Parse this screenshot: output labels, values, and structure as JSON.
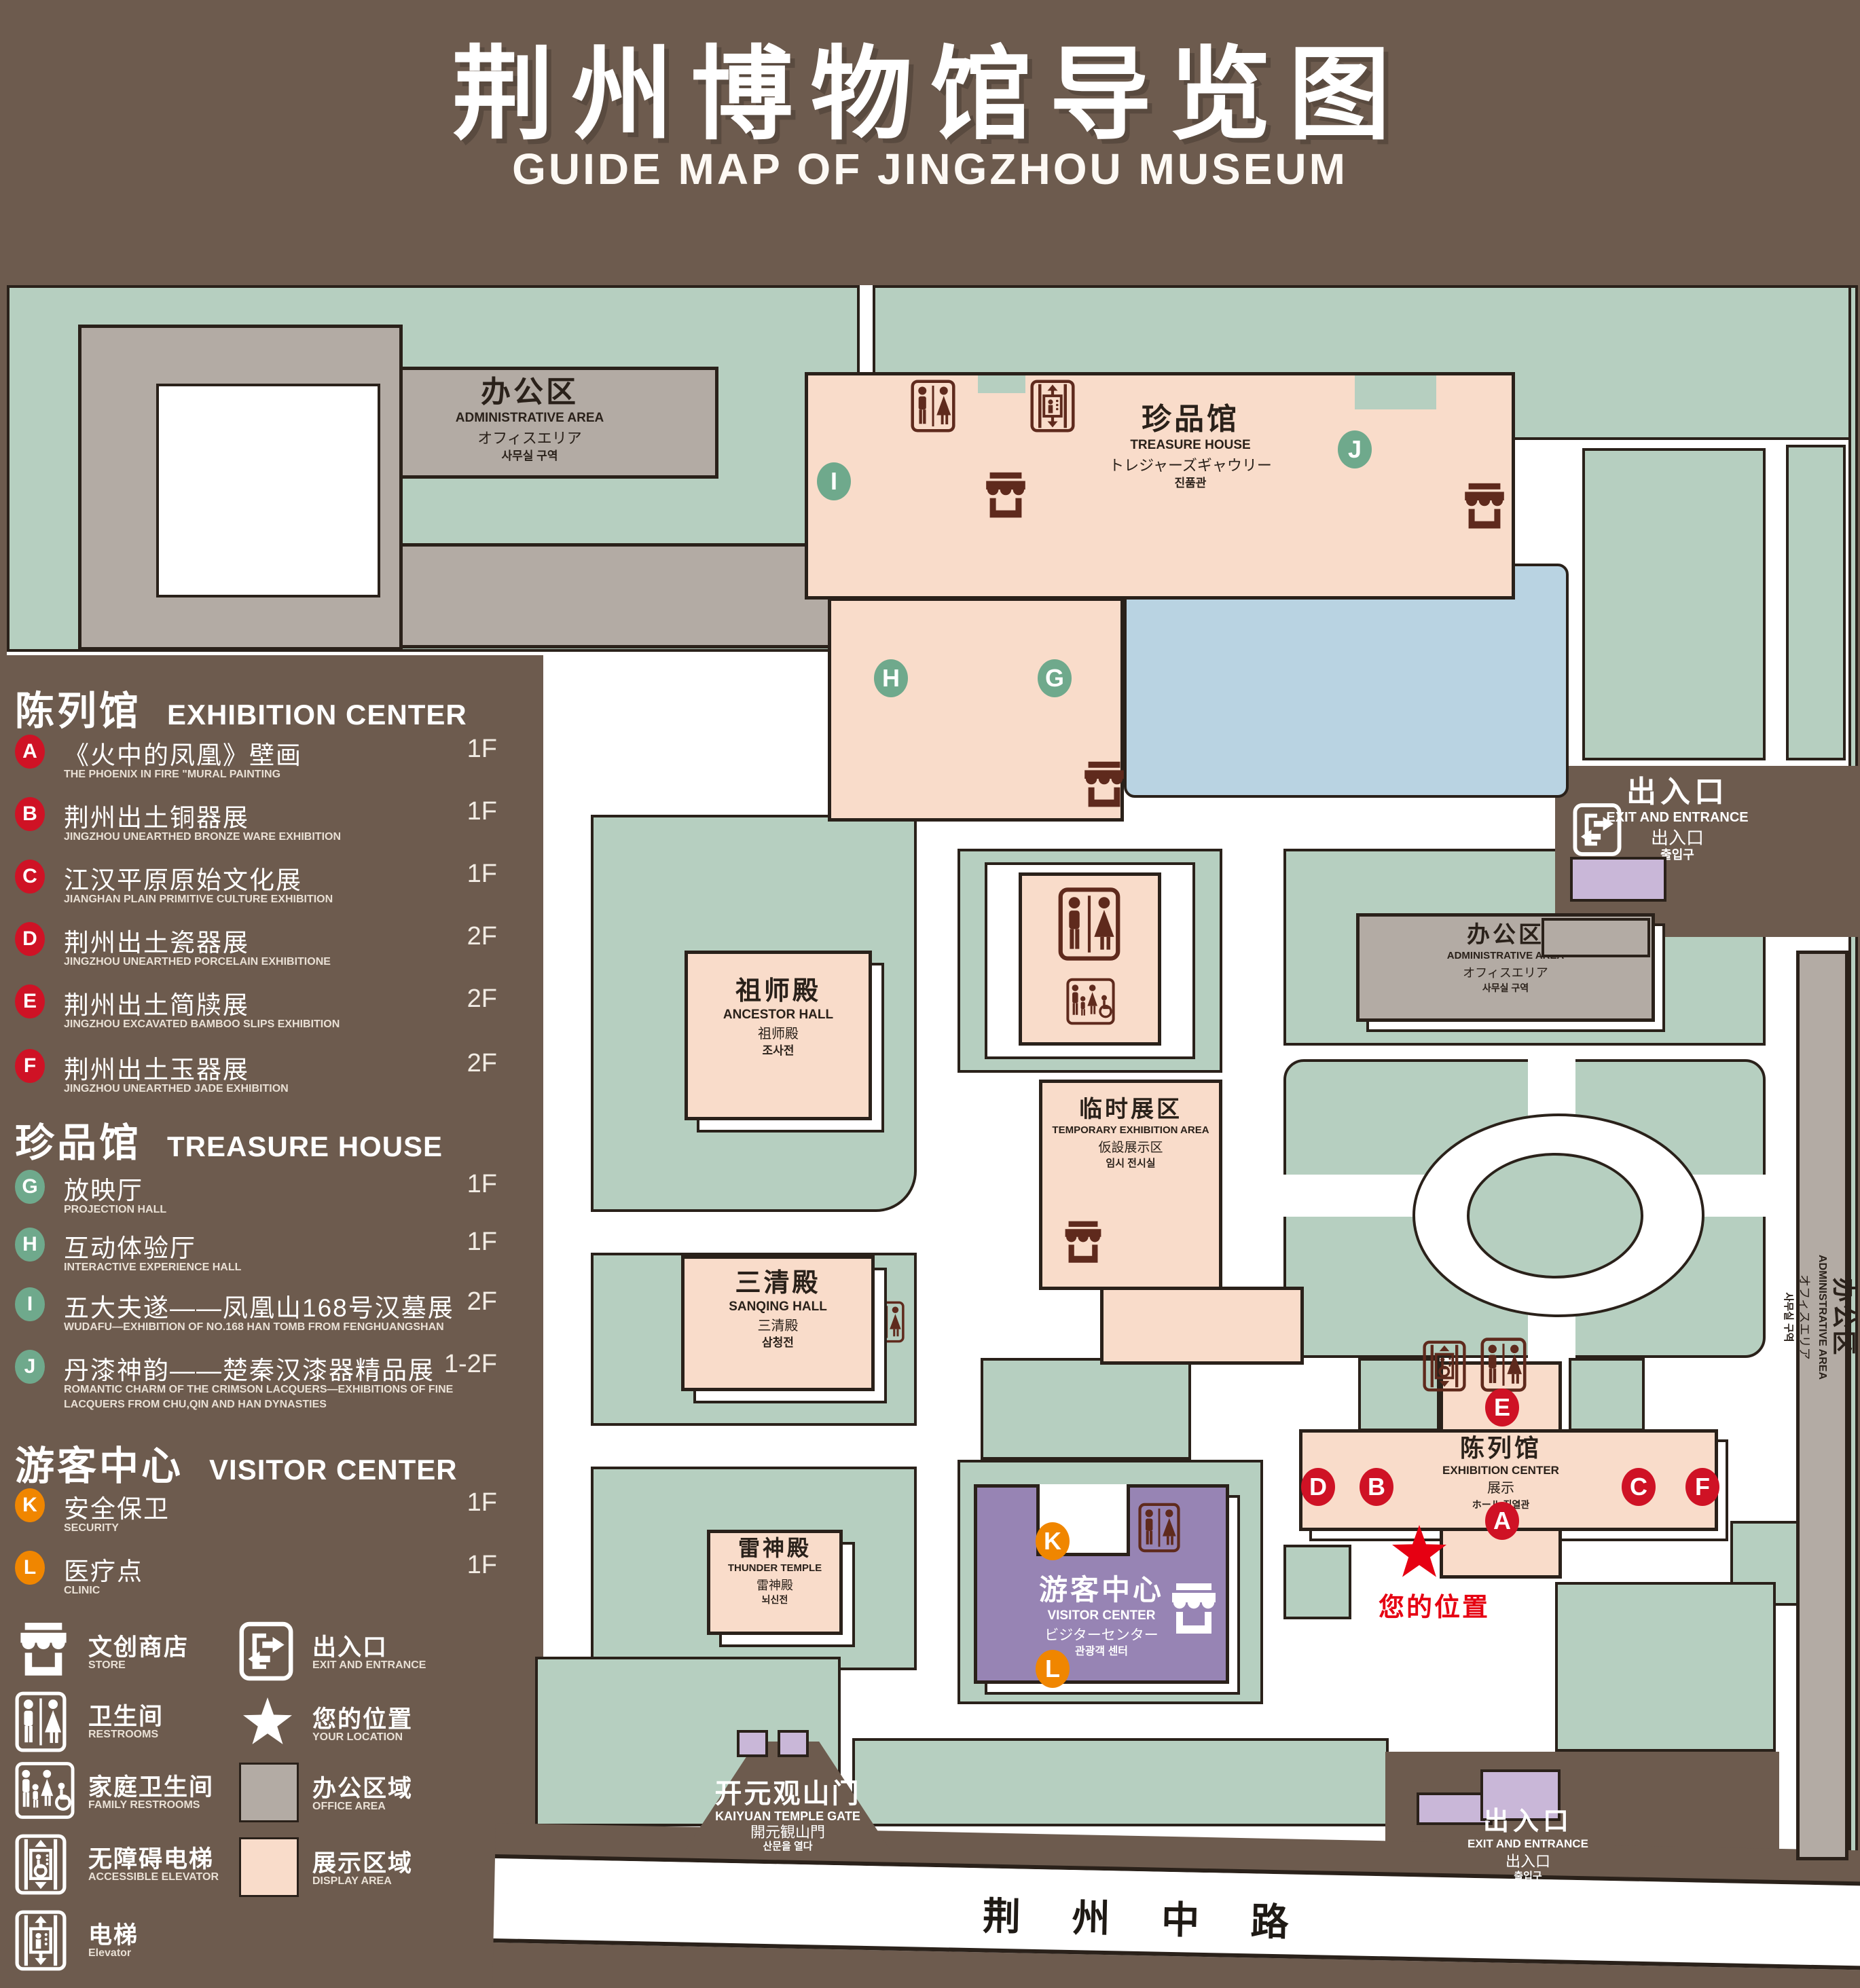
{
  "title": {
    "cn": "荆州博物馆导览图",
    "en": "GUIDE MAP OF JINGZHOU MUSEUM"
  },
  "colors": {
    "background": "#6d5b4e",
    "lawn": "#b6cfc0",
    "outline": "#2a211a",
    "display_area": "#f9dcca",
    "office_area": "#b3aba4",
    "pond": "#b9d3e2",
    "visitor_center": "#9784b4",
    "light_purple": "#c9b7d8",
    "marker_red": "#cf1225",
    "marker_green": "#6fa98c",
    "marker_orange": "#f08600",
    "icon_maroon": "#5f2a1d",
    "location_red": "#e60012"
  },
  "legend": {
    "sections": [
      {
        "cn": "陈列馆",
        "en": "EXHIBITION CENTER",
        "items": [
          {
            "key": "A",
            "cn": "《火中的凤凰》壁画",
            "en": "THE PHOENIX IN FIRE \"MURAL PAINTING",
            "floor": "1F"
          },
          {
            "key": "B",
            "cn": "荆州出土铜器展",
            "en": "JINGZHOU UNEARTHED BRONZE WARE EXHIBITION",
            "floor": "1F"
          },
          {
            "key": "C",
            "cn": "江汉平原原始文化展",
            "en": "JIANGHAN PLAIN PRIMITIVE CULTURE EXHIBITION",
            "floor": "1F"
          },
          {
            "key": "D",
            "cn": "荆州出土瓷器展",
            "en": "JINGZHOU UNEARTHED PORCELAIN EXHIBITIONE",
            "floor": "2F"
          },
          {
            "key": "E",
            "cn": "荆州出土简牍展",
            "en": "JINGZHOU EXCAVATED BAMBOO SLIPS EXHIBITION",
            "floor": "2F"
          },
          {
            "key": "F",
            "cn": "荆州出土玉器展",
            "en": "JINGZHOU UNEARTHED JADE EXHIBITION",
            "floor": "2F"
          }
        ]
      },
      {
        "cn": "珍品馆",
        "en": "TREASURE HOUSE",
        "items": [
          {
            "key": "G",
            "cn": "放映厅",
            "en": "PROJECTION HALL",
            "floor": "1F"
          },
          {
            "key": "H",
            "cn": "互动体验厅",
            "en": "INTERACTIVE EXPERIENCE HALL",
            "floor": "1F"
          },
          {
            "key": "I",
            "cn": "五大夫遂——凤凰山168号汉墓展",
            "en": "WUDAFU—EXHIBITION OF NO.168 HAN TOMB FROM FENGHUANGSHAN",
            "floor": "2F"
          },
          {
            "key": "J",
            "cn": "丹漆神韵——楚秦汉漆器精品展",
            "en": "ROMANTIC CHARM OF THE CRIMSON LACQUERS—EXHIBITIONS OF FINE LACQUERS FROM CHU,QIN AND HAN DYNASTIES",
            "floor": "1-2F"
          }
        ]
      },
      {
        "cn": "游客中心",
        "en": "VISITOR CENTER",
        "items": [
          {
            "key": "K",
            "cn": "安全保卫",
            "en": "SECURITY",
            "floor": "1F"
          },
          {
            "key": "L",
            "cn": "医疗点",
            "en": "CLINIC",
            "floor": "1F"
          }
        ]
      }
    ],
    "symbols": [
      {
        "icon": "store-icon",
        "cn": "文创商店",
        "en": "STORE"
      },
      {
        "icon": "exit-icon",
        "cn": "出入口",
        "en": "EXIT AND ENTRANCE"
      },
      {
        "icon": "restroom-icon",
        "cn": "卫生间",
        "en": "RESTROOMS"
      },
      {
        "icon": "location-star-icon",
        "cn": "您的位置",
        "en": "YOUR LOCATION"
      },
      {
        "icon": "family-restroom-icon",
        "cn": "家庭卫生间",
        "en": "FAMILY RESTROOMS"
      },
      {
        "icon": "office-area-swatch",
        "cn": "办公区域",
        "en": "OFFICE AREA"
      },
      {
        "icon": "accessible-elevator-icon",
        "cn": "无障碍电梯",
        "en": "ACCESSIBLE ELEVATOR"
      },
      {
        "icon": "display-area-swatch",
        "cn": "展示区域",
        "en": "DISPLAY AREA"
      },
      {
        "icon": "elevator-icon",
        "cn": "电梯",
        "en": "Elevator"
      }
    ]
  },
  "map": {
    "markers": {
      "A": "A",
      "B": "B",
      "C": "C",
      "D": "D",
      "E": "E",
      "F": "F",
      "G": "G",
      "H": "H",
      "I": "I",
      "J": "J",
      "K": "K",
      "L": "L"
    },
    "buildings": {
      "admin_top_left": {
        "cn": "办公区",
        "en": "ADMINISTRATIVE AREA",
        "jp": "オフィスエリア",
        "kr": "사무실 구역"
      },
      "treasure_house": {
        "cn": "珍品馆",
        "en": "TREASURE HOUSE",
        "jp": "トレジャーズギャウリー",
        "kr": "진품관"
      },
      "ancestor_hall": {
        "cn": "祖师殿",
        "en": "ANCESTOR HALL",
        "jp": "祖师殿",
        "kr": "조사전"
      },
      "temporary_exhibition": {
        "cn": "临时展区",
        "en": "TEMPORARY EXHIBITION AREA",
        "jp": "仮設展示区",
        "kr": "임시 전시실"
      },
      "sanqing_hall": {
        "cn": "三清殿",
        "en": "SANQING HALL",
        "jp": "三清殿",
        "kr": "삼청전"
      },
      "thunder_temple": {
        "cn": "雷神殿",
        "en": "THUNDER TEMPLE",
        "jp": "雷神殿",
        "kr": "뇌신전"
      },
      "admin_right": {
        "cn": "办公区",
        "en": "ADMINISTRATIVE AREA",
        "jp": "オフィスエリア",
        "kr": "사무실 구역"
      },
      "admin_east": {
        "cn": "办公区",
        "en": "ADMINISTRATIVE AREA",
        "jp": "オフィスエリア",
        "kr": "사무실 구역"
      },
      "exhibition_center": {
        "cn": "陈列馆",
        "en": "EXHIBITION CENTER",
        "jp": "展示",
        "kr": "ホール 진열관"
      },
      "visitor_center": {
        "cn": "游客中心",
        "en": "VISITOR CENTER",
        "jp": "ビジターセンター",
        "kr": "관광객 센터"
      },
      "kaiyuan_gate": {
        "cn": "开元观山门",
        "en": "KAIYUAN TEMPLE GATE",
        "jp": "開元観山門",
        "kr": "산문을 열다"
      }
    },
    "exits": {
      "east": {
        "cn": "出入口",
        "en": "EXIT AND ENTRANCE",
        "cn_sub": "出入口",
        "kr": "출입구"
      },
      "south": {
        "cn": "出入口",
        "en": "EXIT AND ENTRANCE",
        "cn_sub": "出入口",
        "kr": "출입구"
      }
    },
    "road": {
      "label": "荆 州 中 路"
    },
    "your_location": {
      "label": "您的位置"
    }
  }
}
